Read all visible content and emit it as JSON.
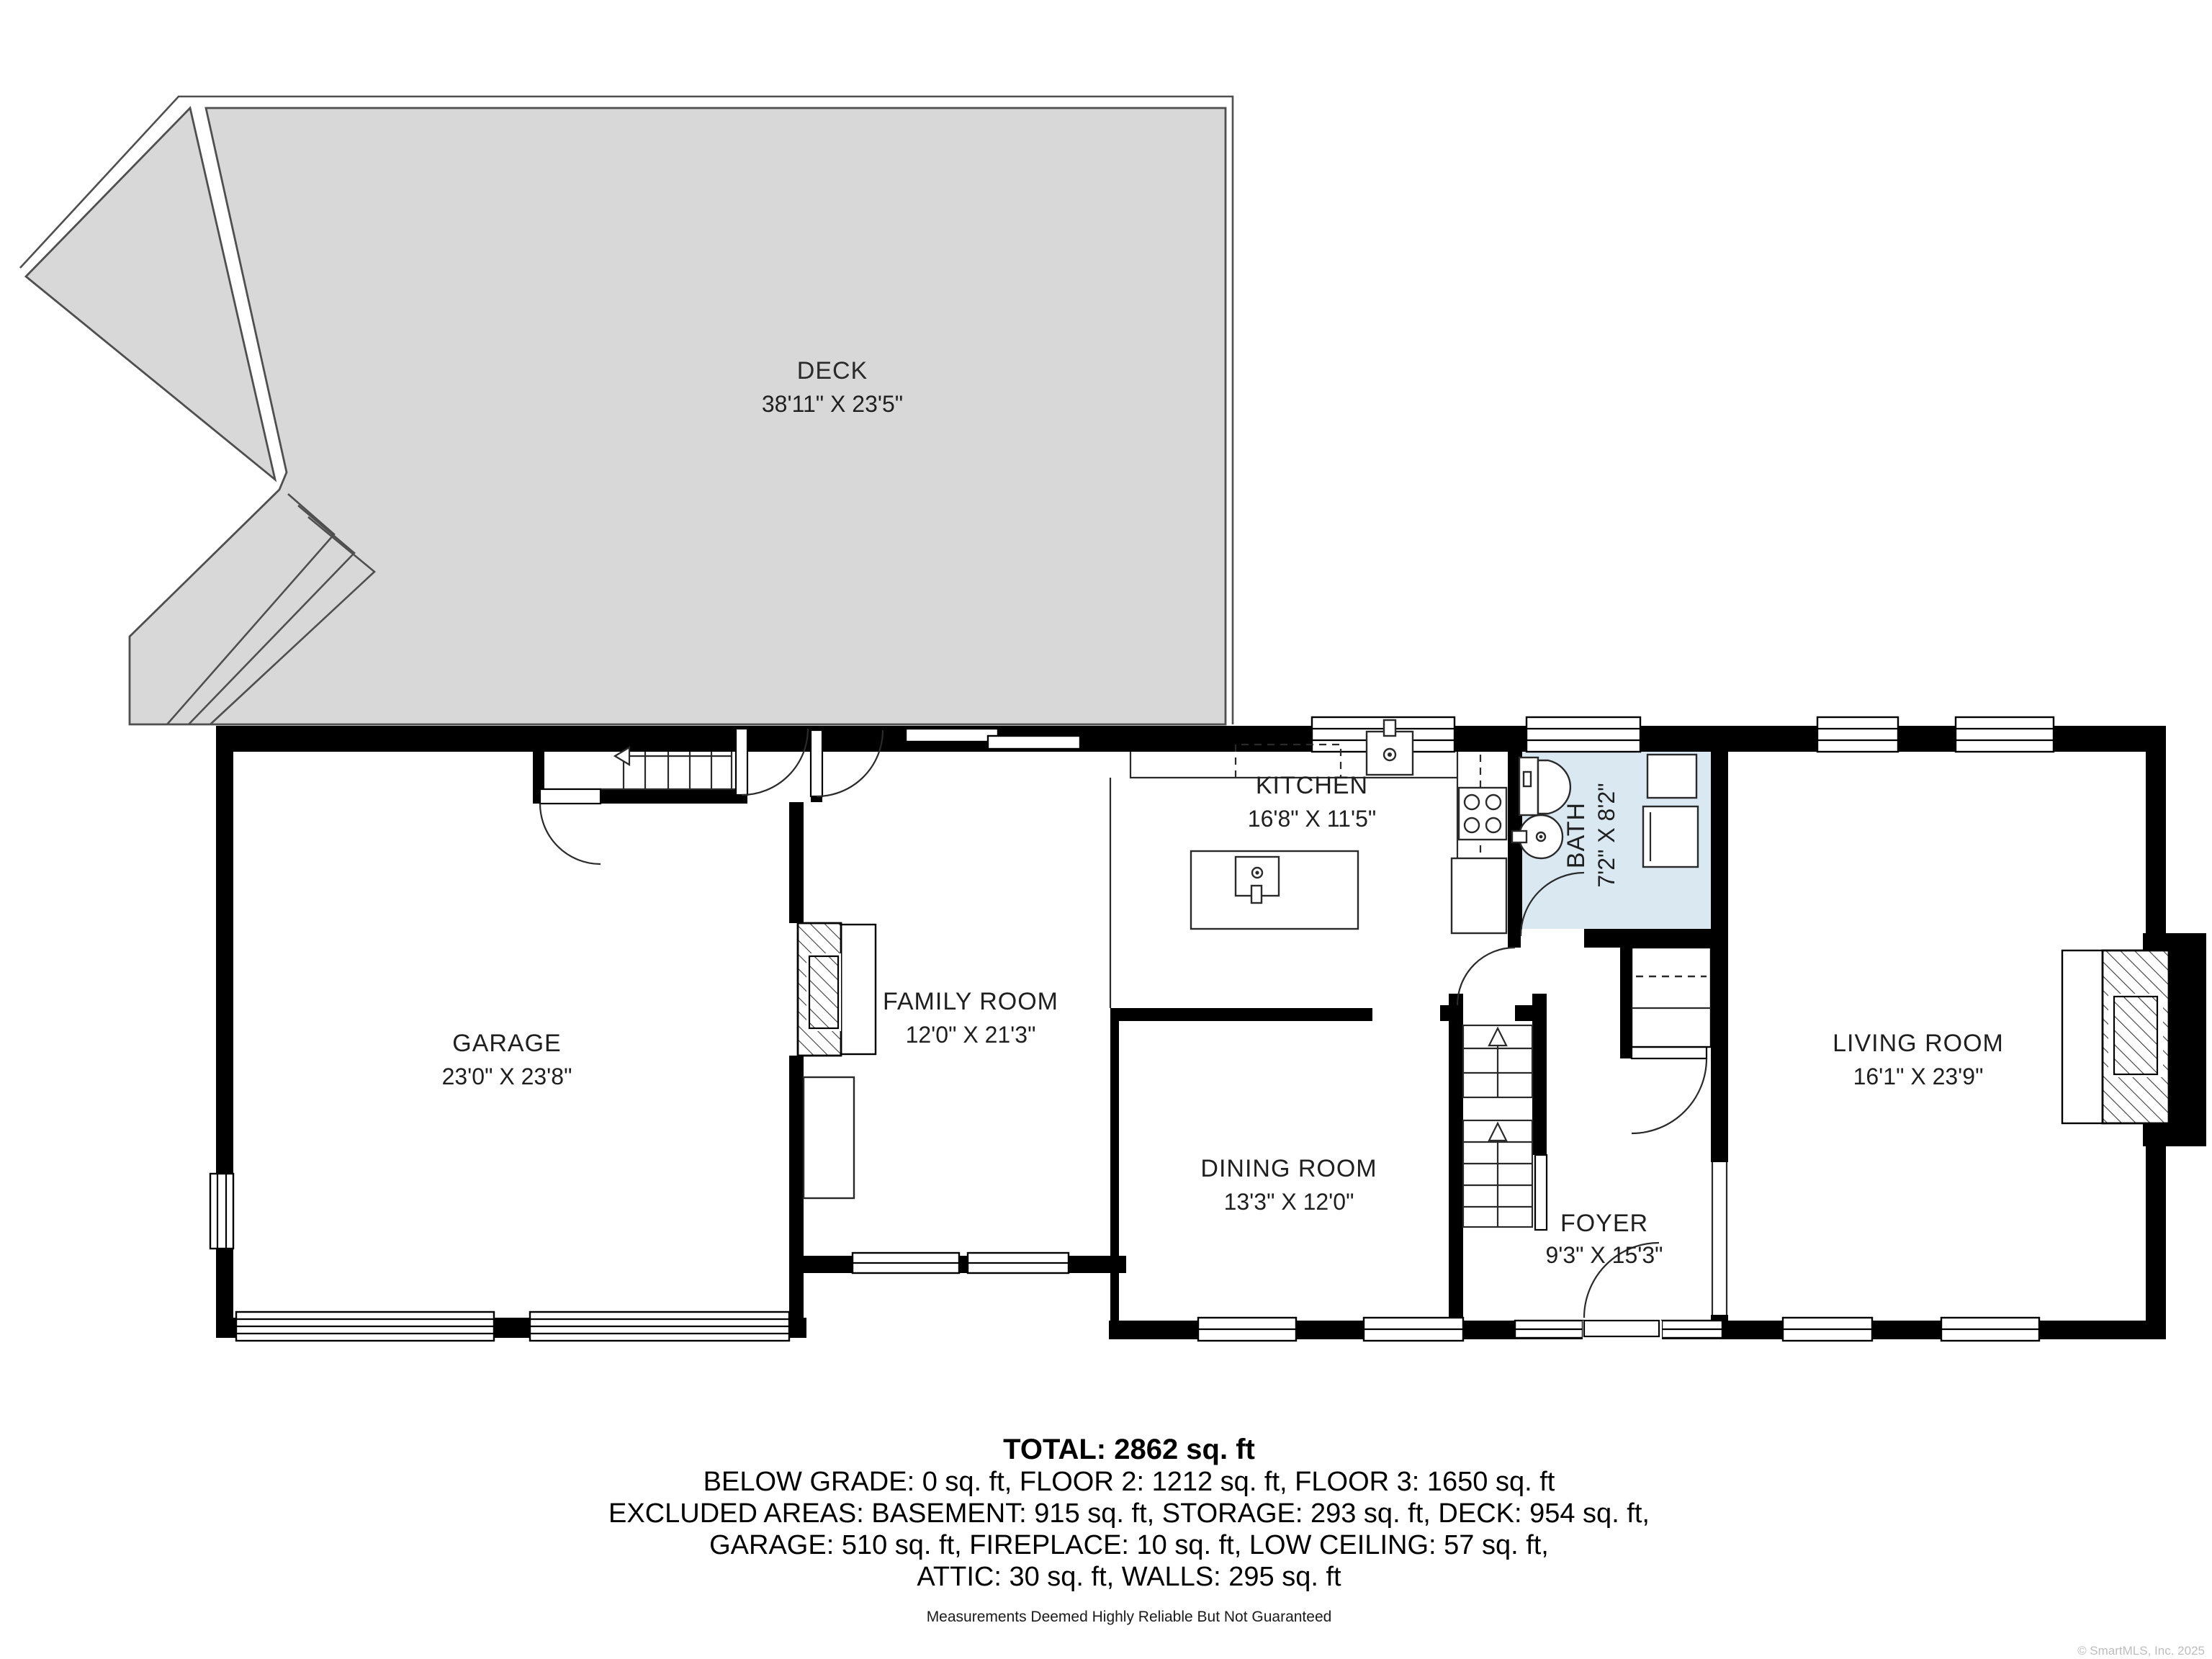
{
  "rooms": {
    "deck": {
      "name": "DECK",
      "dims": "38'11\" X 23'5\""
    },
    "kitchen": {
      "name": "KITCHEN",
      "dims": "16'8\" X 11'5\""
    },
    "bath": {
      "name": "BATH",
      "dims": "7'2\" X 8'2\""
    },
    "garage": {
      "name": "GARAGE",
      "dims": "23'0\" X 23'8\""
    },
    "family_room": {
      "name": "FAMILY ROOM",
      "dims": "12'0\" X 21'3\""
    },
    "dining_room": {
      "name": "DINING ROOM",
      "dims": "13'3\" X 12'0\""
    },
    "foyer": {
      "name": "FOYER",
      "dims": "9'3\" X 15'3\""
    },
    "living_room": {
      "name": "LIVING ROOM",
      "dims": "16'1\" X 23'9\""
    }
  },
  "summary": {
    "total": "TOTAL: 2862 sq. ft",
    "line1": "BELOW GRADE: 0 sq. ft, FLOOR 2: 1212 sq. ft, FLOOR 3: 1650 sq. ft",
    "line2": "EXCLUDED AREAS: BASEMENT: 915 sq. ft, STORAGE: 293 sq. ft, DECK: 954 sq. ft,",
    "line3": "GARAGE: 510 sq. ft, FIREPLACE: 10 sq. ft, LOW CEILING: 57 sq. ft,",
    "line4": "ATTIC: 30 sq. ft, WALLS: 295 sq. ft"
  },
  "disclaimer": "Measurements Deemed Highly Reliable But Not Guaranteed",
  "watermark": "© SmartMLS, Inc.  2025",
  "colors": {
    "deck_fill": "#d8d8d8",
    "bath_fill": "#d9e8f1",
    "wall": "#000000"
  }
}
